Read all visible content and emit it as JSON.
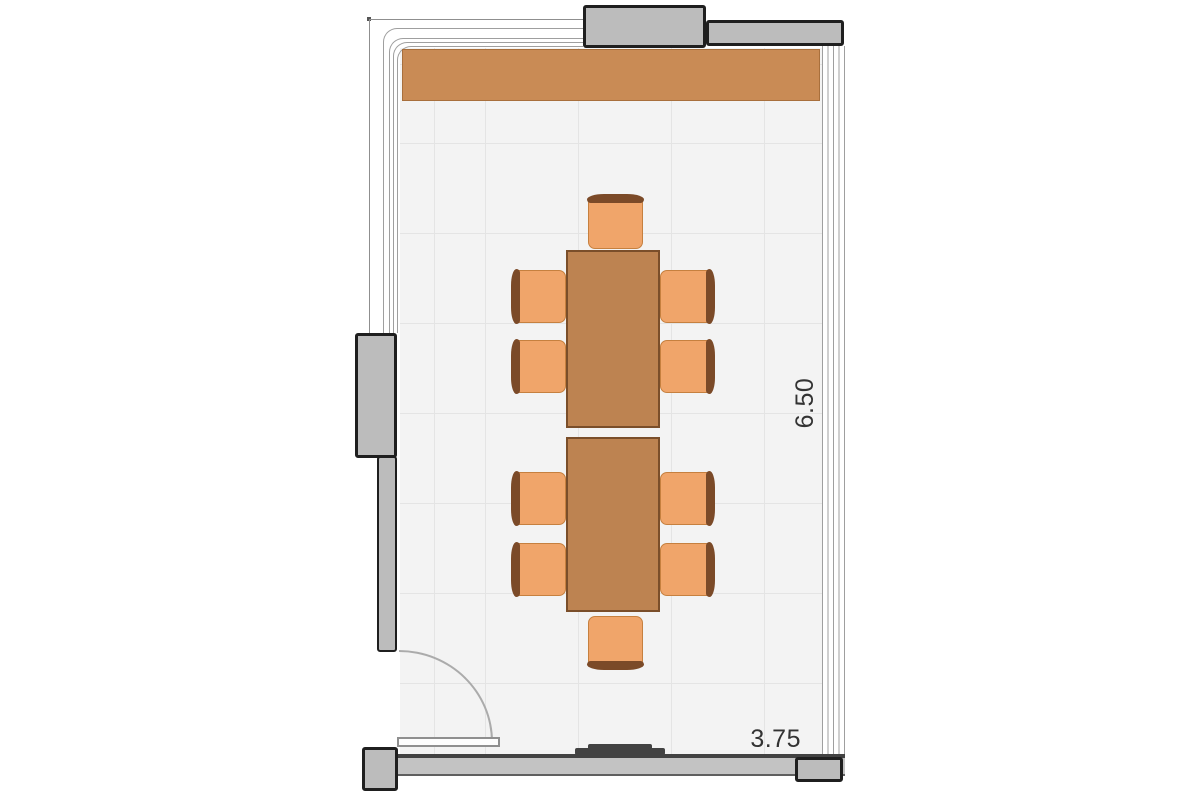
{
  "dimensions": {
    "height_label": "6.50",
    "width_label": "3.75"
  },
  "plan": {
    "room": {
      "width": "3.75",
      "length": "6.50"
    },
    "furniture": {
      "counter_count": 1,
      "table_count": 2,
      "chair_count": 10,
      "door_count": 1,
      "window_walls": [
        "left",
        "top",
        "right"
      ]
    }
  },
  "colors": {
    "floor": "#f3f3f3",
    "grid_line": "#e4e4e4",
    "line_gray": "#9f9f9f",
    "wall_fill": "#bcbcbc",
    "wall_outline": "#1f1f1f",
    "wall_dark": "#424242",
    "counter": "#c98b55",
    "table": "#bd8351",
    "table_outline": "#7a4e2a",
    "chair_seat": "#f0a56a",
    "chair_outline": "#c6803f",
    "chair_back": "#7b4a28",
    "dim_text": "#333333"
  }
}
